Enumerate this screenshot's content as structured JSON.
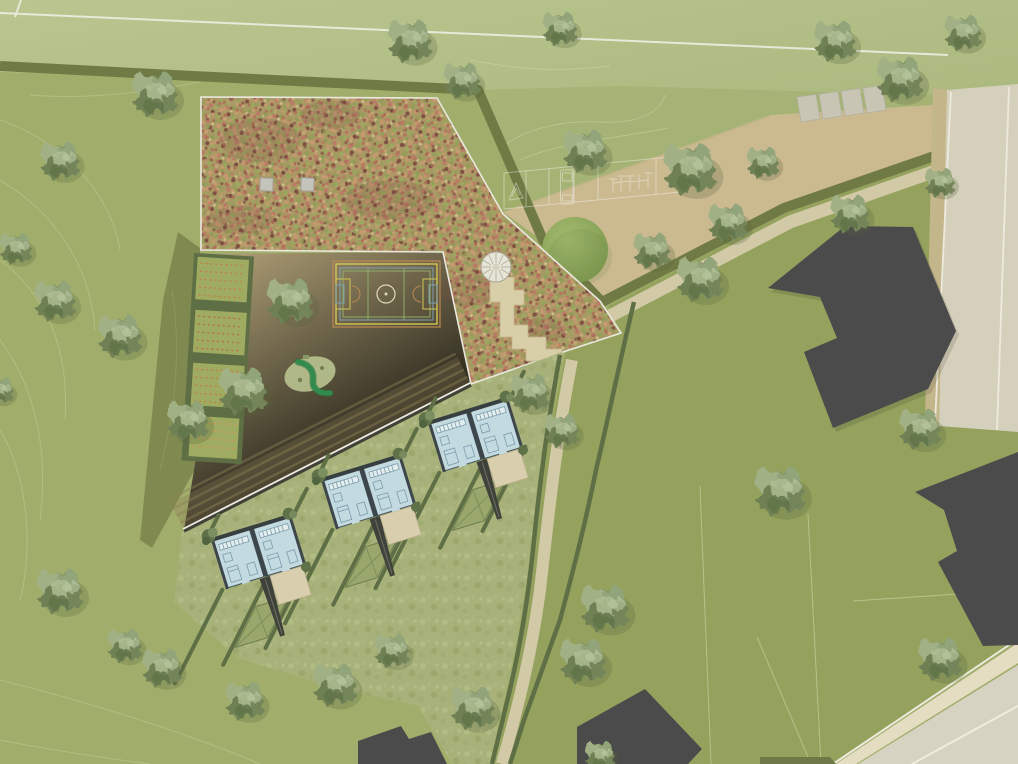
{
  "meta": {
    "kind": "architectural-site-plan",
    "view": "top-down aerial rendering",
    "text_labels": []
  },
  "palette": {
    "base_green": "#a3b06d",
    "field_light": "#b6c38b",
    "upper_lawn": "#a9b77a",
    "east_lawn": "#95a45f",
    "meadow_green": "#a9b47c",
    "courtyard_tan": "#b3a278",
    "plaza_tan": "#cfbd94",
    "path_pale": "#d6cdab",
    "ditch_olive": "#6f7a45",
    "hedge_green": "#5d6e45",
    "wedge_olive": "#7c874e",
    "sedum_base": "#ab9a66",
    "roof_outline": "#f0efe8",
    "building_gray": "#47484a",
    "road_light": "#d9d4c1",
    "road_cream": "#eae2c9",
    "verge_tan": "#c8b98f",
    "line_white": "#f2f4ea",
    "silver_line": "#f2f2ec",
    "contour": "#c6d29d",
    "house_floor": "#c7dfe9",
    "house_wall": "#39434a",
    "terrace_beige": "#ded3b4",
    "court_yellow": "#d9ca55",
    "court_orange": "#c08a54",
    "court_blue": "#7fa3b5",
    "court_green": "#8fae6d",
    "tree_green": "#87996b",
    "shrub_green": "#8fac5f",
    "slab_gray": "#ccc9ba",
    "allotment_bed": "#a0ad61",
    "allotment_rows": "#c77e4b"
  },
  "features": {
    "sports_field": {
      "label": "playing-field",
      "white_marking_lines": 2
    },
    "green_roof": {
      "label": "sedum-green-roof",
      "skylights": 2,
      "outline": "white"
    },
    "roof_access": {
      "spiral_stair": 1,
      "stepped_path": 1
    },
    "courtyard": {
      "sports_court": 1,
      "court_line_colors": [
        "yellow",
        "orange",
        "blue",
        "green"
      ],
      "center_circle": 1,
      "goal_boxes": 2,
      "playground_slide": 1,
      "allotment_plots": 4,
      "large_trees": 2
    },
    "plaza": {
      "shrub_mound": 1,
      "paving_slabs": 4,
      "sketched_equipment": [
        "a-frame",
        "storage-container",
        "exercise-bars"
      ]
    },
    "housing": {
      "pairs": 3,
      "units": 6,
      "terraces": 3,
      "access_ramps": 3,
      "garden_panels": 3,
      "hedge_rows": 15
    },
    "existing_buildings": {
      "count": 4
    },
    "roads": {
      "east_road": 1,
      "southeast_road": 1,
      "footpaths": 2
    },
    "vegetation": {
      "trees": 38,
      "contour_lines": true
    },
    "parcel_lines": 4
  }
}
